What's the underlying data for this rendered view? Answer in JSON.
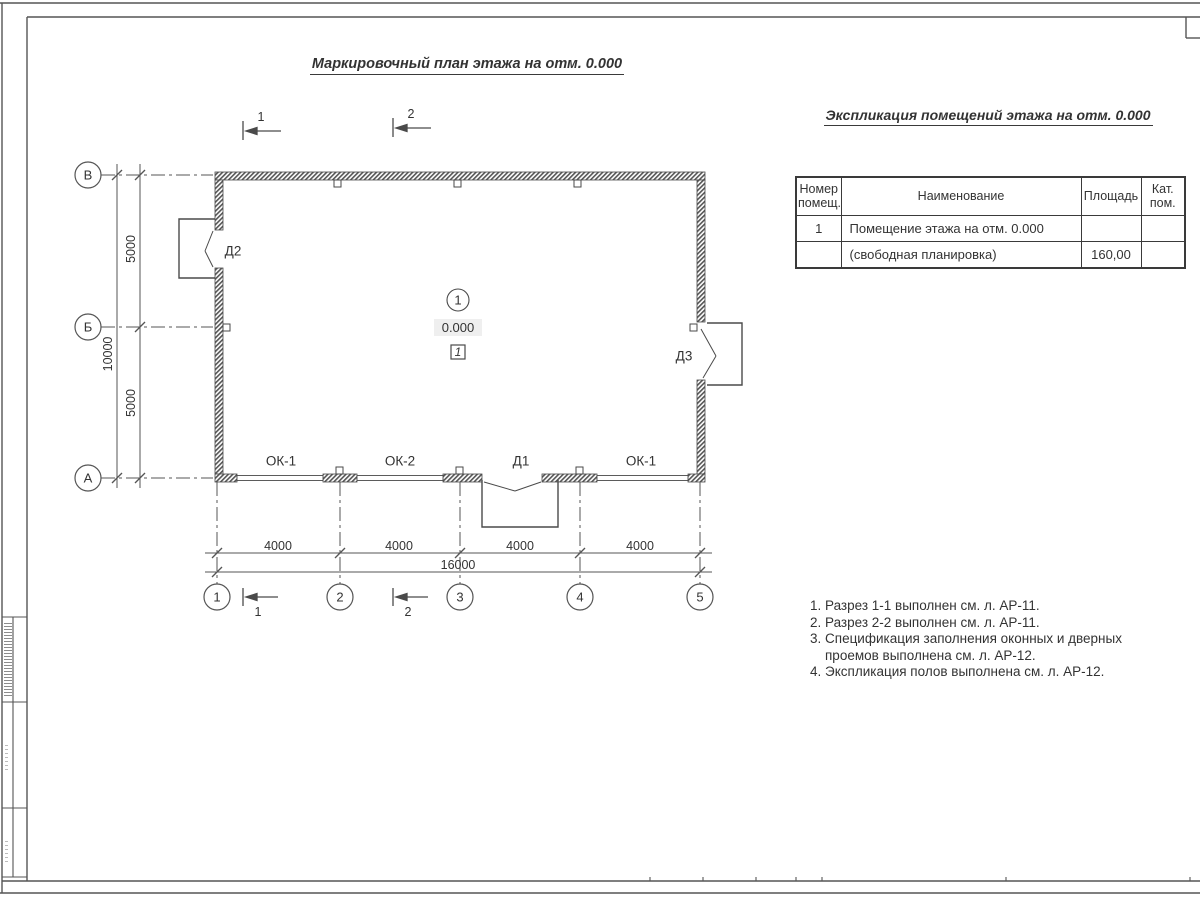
{
  "sheet_title": "Маркировочный план этажа на отм. 0.000",
  "table": {
    "title": "Экспликация помещений этажа на отм. 0.000",
    "headers": [
      "Номер помещ.",
      "Наименование",
      "Площадь",
      "Кат. пом."
    ],
    "rows": [
      {
        "num": "1",
        "name": "Помещение этажа на отм. 0.000",
        "area": "",
        "cat": ""
      },
      {
        "num": "",
        "name": "(свободная планировка)",
        "area": "160,00",
        "cat": ""
      }
    ]
  },
  "notes": {
    "line1": "1. Разрез 1-1 выполнен см. л. АР-11.",
    "line2": "2. Разрез 2-2 выполнен см. л. АР-11.",
    "line3": "3. Спецификация заполнения оконных и дверных",
    "line4": "проемов выполнена см. л. АР-12.",
    "line5": "4. Экспликация полов выполнена см. л. АР-12."
  },
  "axes": {
    "rows": [
      "В",
      "Б",
      "А"
    ],
    "cols": [
      "1",
      "2",
      "3",
      "4",
      "5"
    ]
  },
  "dims": {
    "v_inner_top": "5000",
    "v_inner_bottom": "5000",
    "v_total": "10000",
    "h_segments": [
      "4000",
      "4000",
      "4000",
      "4000"
    ],
    "h_total": "16000"
  },
  "labels": {
    "d2": "Д2",
    "d3": "Д3",
    "d1": "Д1",
    "ok1_left": "ОК-1",
    "ok2": "ОК-2",
    "ok1_right": "ОК-1"
  },
  "room": {
    "number": "1",
    "elevation": "0.000",
    "floor_type": "1"
  },
  "sections": {
    "top1": "1",
    "top2": "2",
    "bottom1": "1",
    "bottom2": "2"
  },
  "colors": {
    "line": "#4a4a4a",
    "text": "#333333",
    "elevation_bg": "#efefef"
  }
}
